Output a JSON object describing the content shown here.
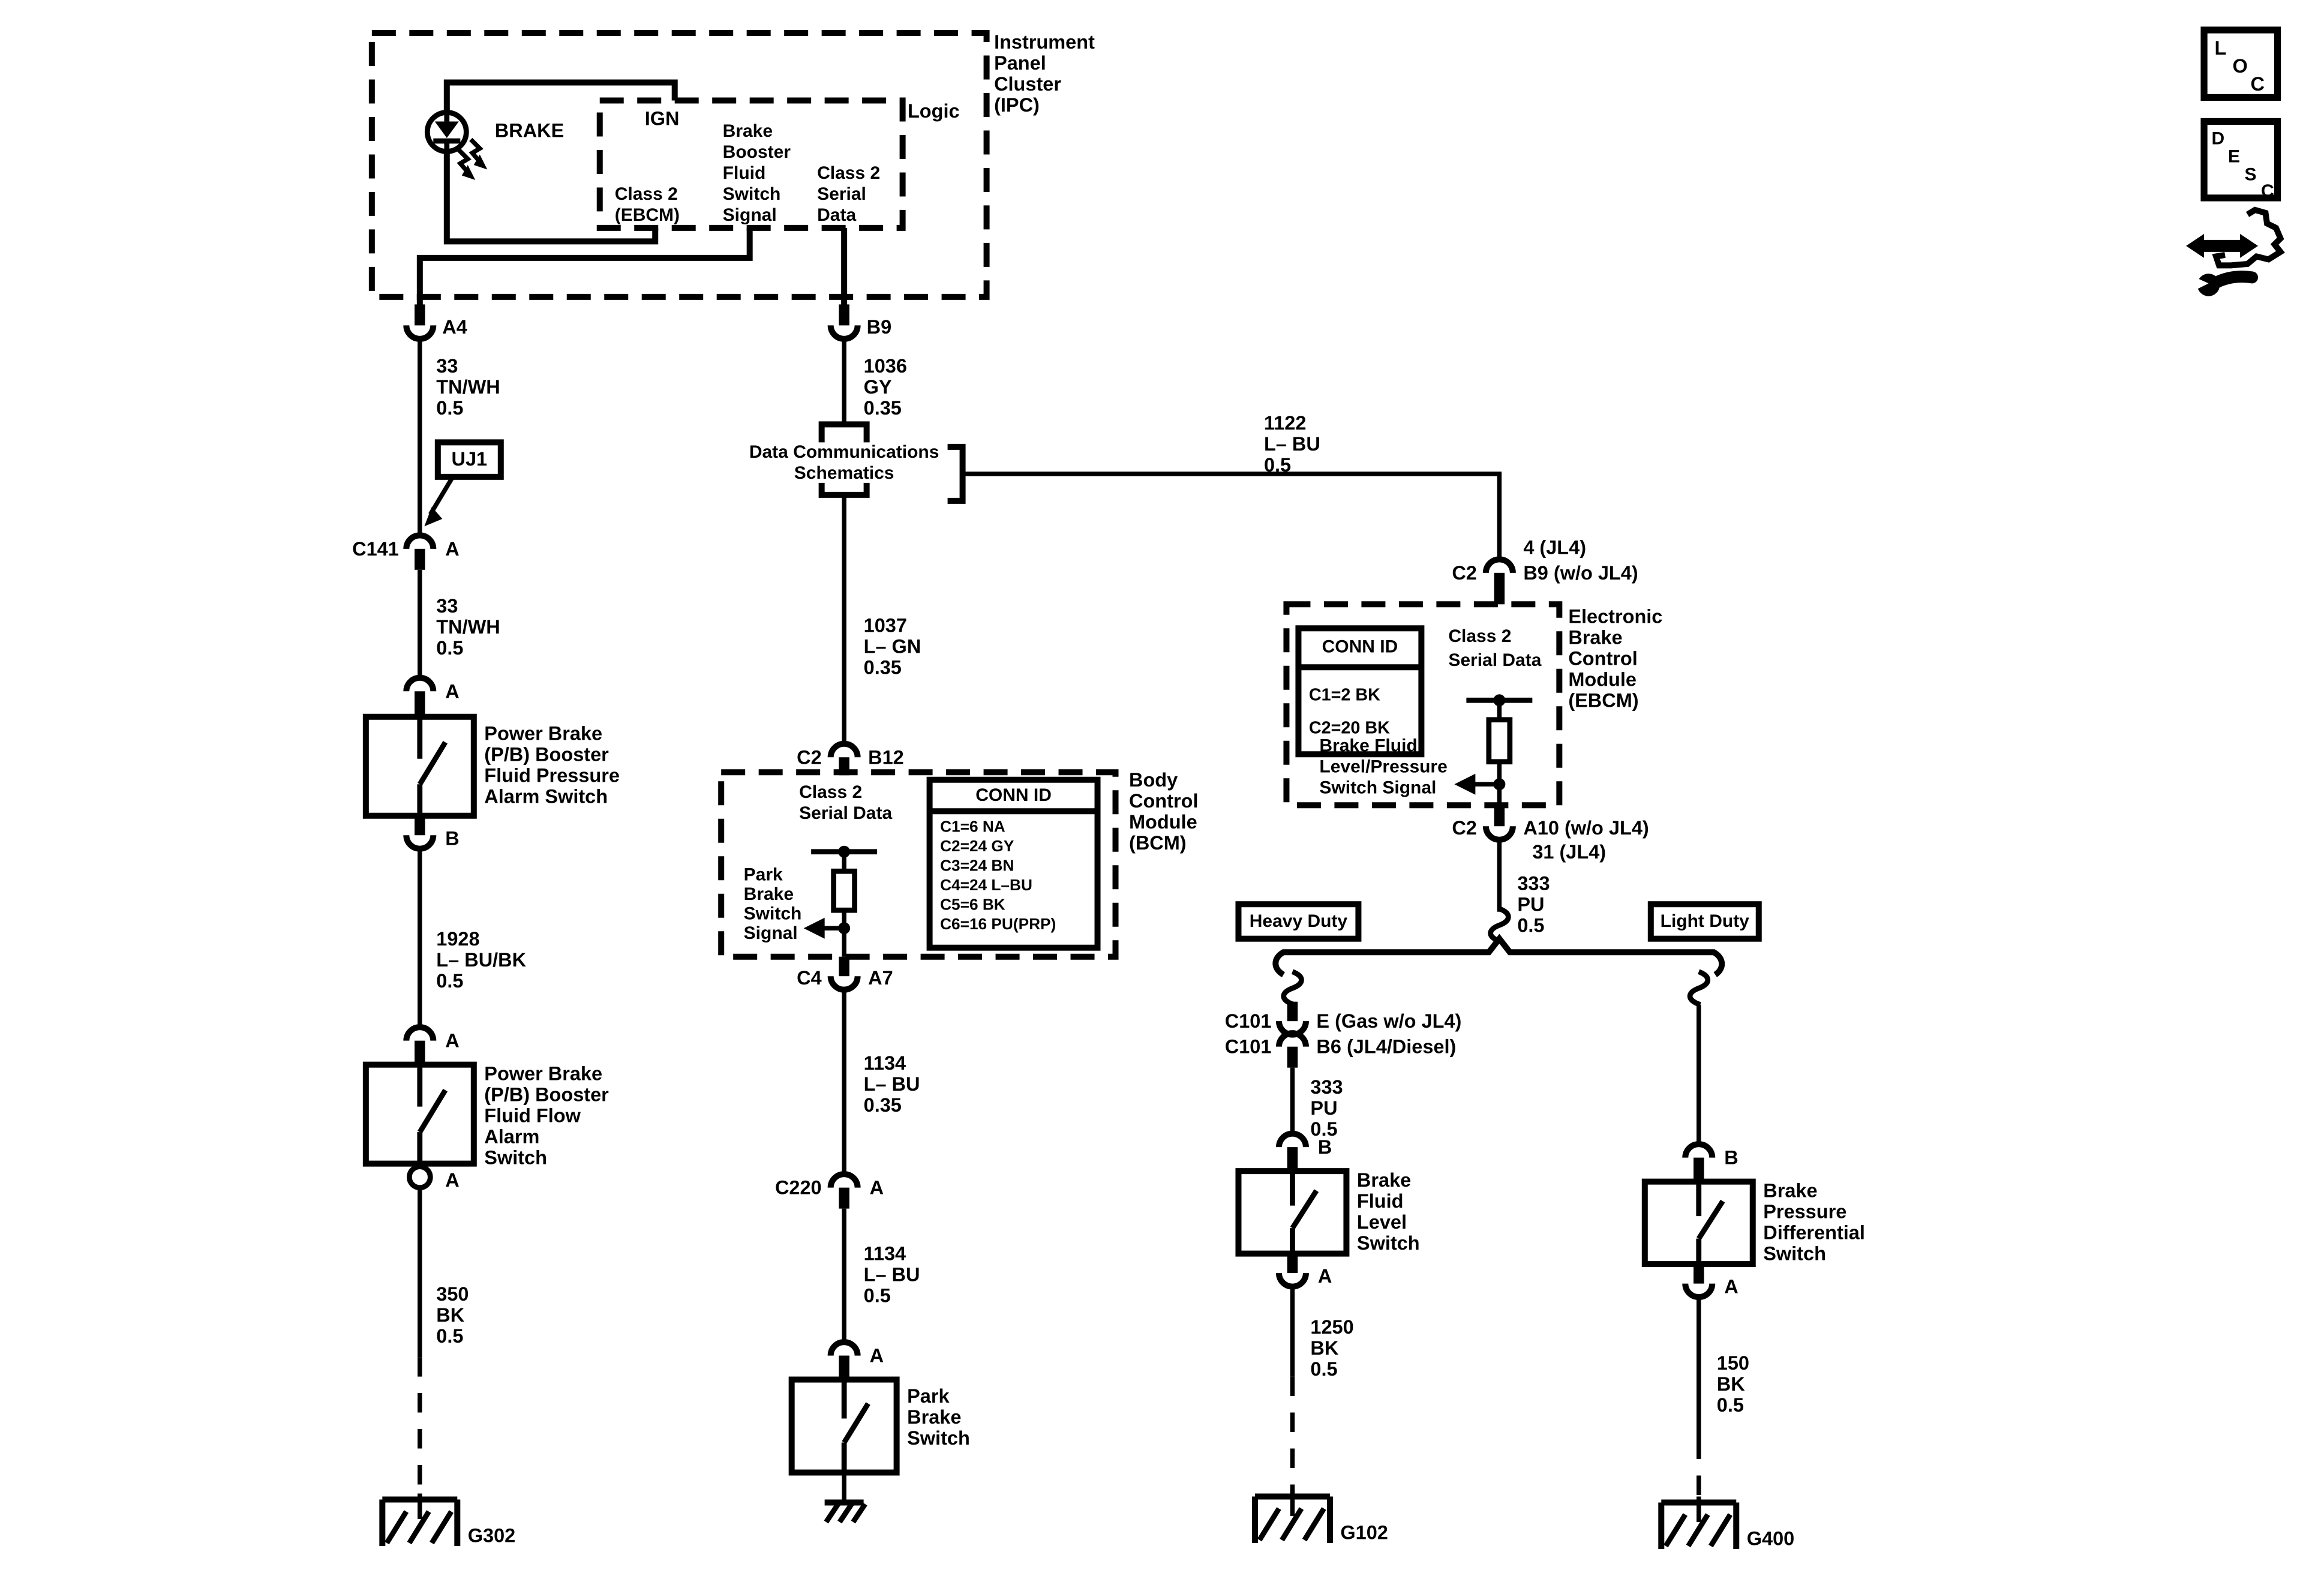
{
  "page": {
    "background": "#ffffff",
    "ink": "#000000"
  },
  "corner": {
    "loc": [
      "L",
      "O",
      "C"
    ],
    "desc": [
      "D",
      "E",
      "S",
      "C"
    ]
  },
  "ipc": {
    "title": [
      "Instrument",
      "Panel",
      "Cluster",
      "(IPC)"
    ],
    "logic": "Logic",
    "lamp": "BRAKE",
    "ign": "IGN",
    "class2_ebcm": [
      "Class 2",
      "(EBCM)"
    ],
    "booster_signal": [
      "Brake",
      "Booster",
      "Fluid",
      "Switch",
      "Signal"
    ],
    "class2_serial": [
      "Class 2",
      "Serial",
      "Data"
    ]
  },
  "left": {
    "a4": "A4",
    "wire_33a": [
      "33",
      "TN/WH",
      "0.5"
    ],
    "uj1": "UJ1",
    "c141": "C141",
    "c141_pin": "A",
    "wire_33b": [
      "33",
      "TN/WH",
      "0.5"
    ],
    "pin_a_top": "A",
    "pressure_switch": [
      "Power Brake",
      "(P/B) Booster",
      "Fluid Pressure",
      "Alarm Switch"
    ],
    "pin_b": "B",
    "wire_1928": [
      "1928",
      "L– BU/BK",
      "0.5"
    ],
    "pin_a_mid": "A",
    "flow_switch": [
      "Power Brake",
      "(P/B) Booster",
      "Fluid Flow",
      "Alarm",
      "Switch"
    ],
    "pin_a_bot": "A",
    "wire_350": [
      "350",
      "BK",
      "0.5"
    ],
    "ground": "G302"
  },
  "mid": {
    "b9": "B9",
    "wire_1036": [
      "1036",
      "GY",
      "0.35"
    ],
    "dcs": [
      "Data Communications",
      "Schematics"
    ],
    "wire_1037": [
      "1037",
      "L– GN",
      "0.35"
    ],
    "c2": "C2",
    "b12": "B12",
    "bcm_class2": [
      "Class 2",
      "Serial Data"
    ],
    "conn_title": "CONN ID",
    "conn_rows": [
      "C1=6 NA",
      "C2=24 GY",
      "C3=24 BN",
      "C4=24 L–BU",
      "C5=6 BK",
      "C6=16 PU(PRP)"
    ],
    "park_signal": [
      "Park",
      "Brake",
      "Switch",
      "Signal"
    ],
    "bcm_name": [
      "Body",
      "Control",
      "Module",
      "(BCM)"
    ],
    "c4": "C4",
    "a7": "A7",
    "wire_1134a": [
      "1134",
      "L– BU",
      "0.35"
    ],
    "c220": "C220",
    "c220_pin": "A",
    "wire_1134b": [
      "1134",
      "L– BU",
      "0.5"
    ],
    "pin_a": "A",
    "park_switch": [
      "Park",
      "Brake",
      "Switch"
    ]
  },
  "right": {
    "wire_1122": [
      "1122",
      "L– BU",
      "0.5"
    ],
    "jl4_4": "4 (JL4)",
    "c2_top": "C2",
    "b9_wo": "B9 (w/o JL4)",
    "conn_title": "CONN ID",
    "conn_rows": [
      "C1=2 BK",
      "C2=20 BK"
    ],
    "ebcm_class2": [
      "Class 2",
      "Serial Data"
    ],
    "ebcm_name": [
      "Electronic",
      "Brake",
      "Control",
      "Module",
      "(EBCM)"
    ],
    "fluid_signal": [
      "Brake Fluid",
      "Level/Pressure",
      "Switch Signal"
    ],
    "c2_bot": "C2",
    "a10": "A10 (w/o JL4)",
    "jl4_31": "31 (JL4)",
    "wire_333": [
      "333",
      "PU",
      "0.5"
    ],
    "heavy_duty": "Heavy Duty",
    "light_duty": "Light Duty"
  },
  "heavy": {
    "c101_top": "C101",
    "pin_e": "E (Gas w/o JL4)",
    "c101_bot": "C101",
    "pin_b6": "B6 (JL4/Diesel)",
    "wire_333": [
      "333",
      "PU",
      "0.5"
    ],
    "pin_b": "B",
    "switch": [
      "Brake",
      "Fluid",
      "Level",
      "Switch"
    ],
    "pin_a": "A",
    "wire_1250": [
      "1250",
      "BK",
      "0.5"
    ],
    "ground": "G102"
  },
  "light": {
    "pin_b": "B",
    "switch": [
      "Brake",
      "Pressure",
      "Differential",
      "Switch"
    ],
    "pin_a": "A",
    "wire_150": [
      "150",
      "BK",
      "0.5"
    ],
    "ground": "G400"
  }
}
